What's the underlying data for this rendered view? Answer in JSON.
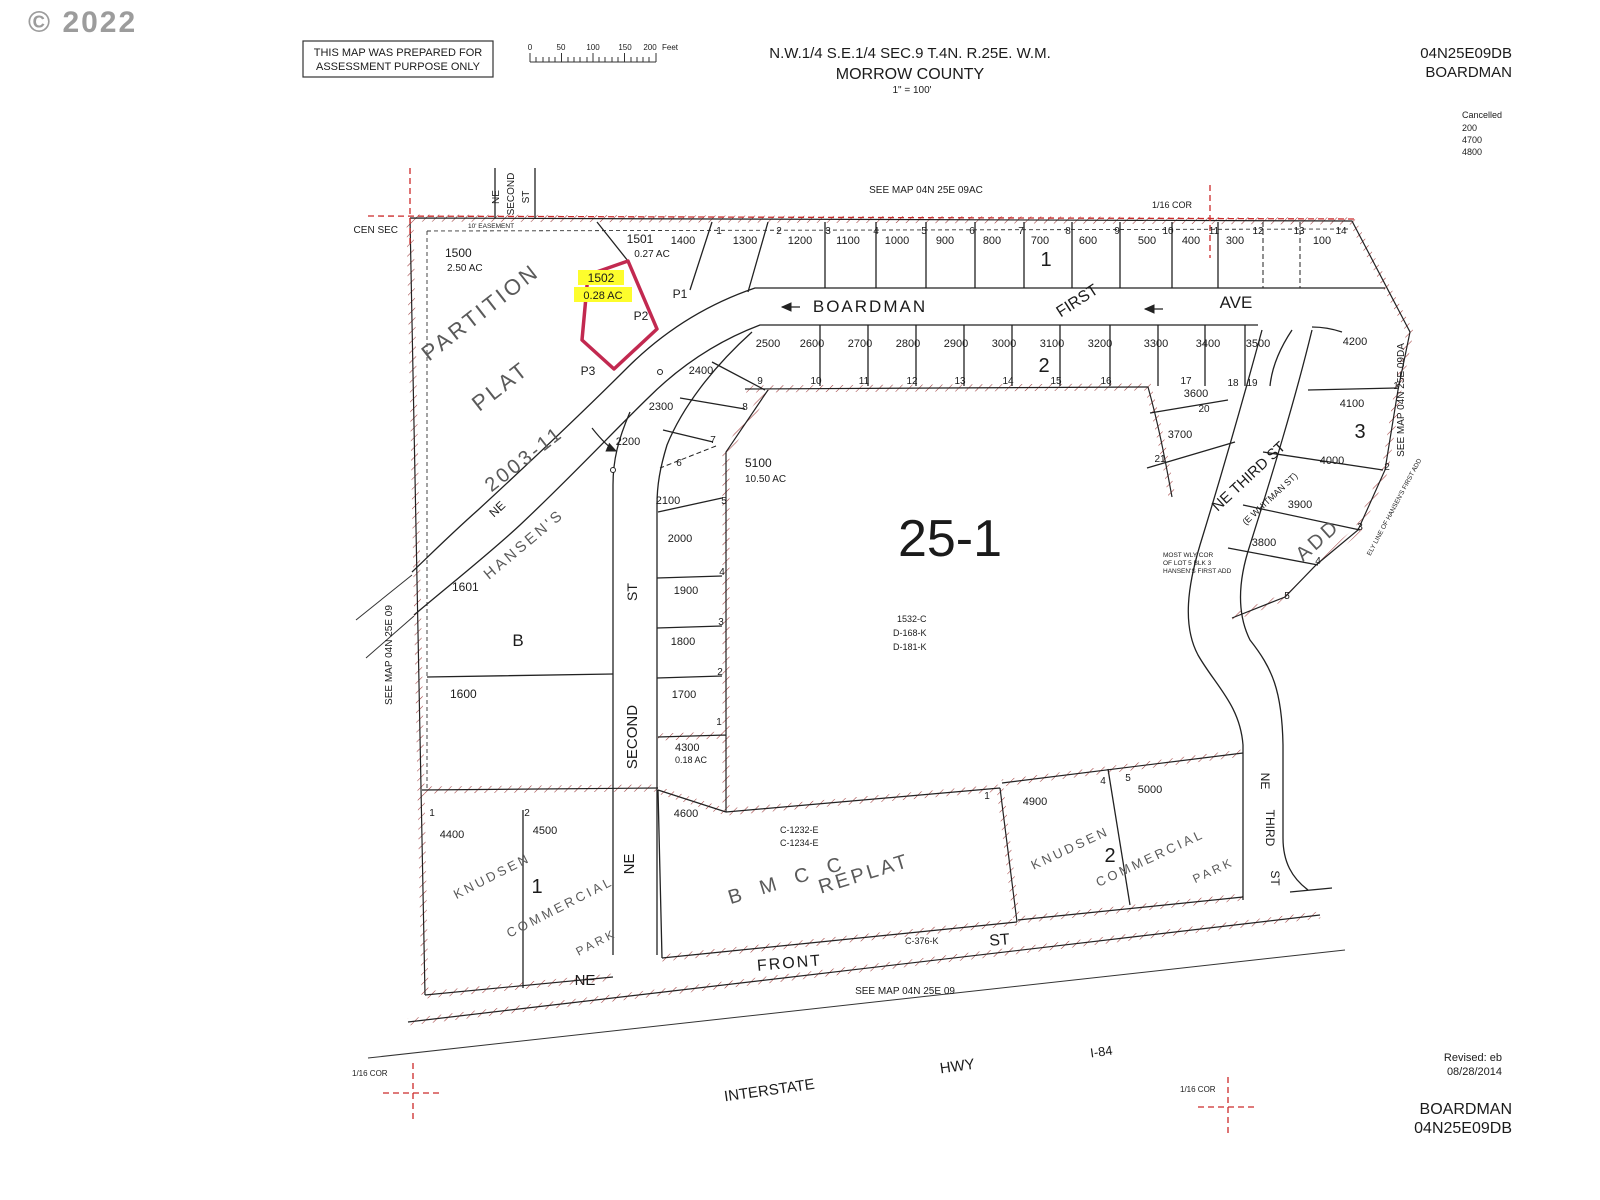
{
  "header": {
    "copyright": "© 2022",
    "disclaimer_line1": "THIS MAP WAS PREPARED FOR",
    "disclaimer_line2": "ASSESSMENT PURPOSE ONLY",
    "scale": {
      "ticks": [
        "0",
        "50",
        "100",
        "150",
        "200"
      ],
      "unit": "Feet"
    },
    "title_line1": "N.W.1/4 S.E.1/4 SEC.9 T.4N. R.25E. W.M.",
    "title_line2": "MORROW COUNTY",
    "title_line3": "1\" = 100'",
    "sheet_id": "04N25E09DB",
    "sheet_name": "BOARDMAN",
    "cancelled_label": "Cancelled",
    "cancelled_lots": [
      "200",
      "4700",
      "4800"
    ]
  },
  "footer": {
    "revised_label": "Revised: eb",
    "revised_date": "08/28/2014",
    "sheet_name": "BOARDMAN",
    "sheet_id": "04N25E09DB"
  },
  "map": {
    "refs": {
      "see_map_top": "SEE MAP 04N 25E 09AC",
      "see_map_left": "SEE MAP 04N 25E 09",
      "see_map_right": "SEE MAP 04N 25E 09DA",
      "see_map_bottom": "SEE MAP 04N 25E 09",
      "cor16": "1/16 COR",
      "cen_sec": "CEN SEC",
      "easement": "10' EASEMENT"
    },
    "streets": {
      "ne": "NE",
      "second": "SECOND",
      "st": "ST",
      "boardman": "BOARDMAN",
      "first": "FIRST",
      "ave": "AVE",
      "hansens": "HANSEN'S",
      "third_st": "NE THIRD ST",
      "whitman": "(E WHITMAN ST)",
      "third": "THIRD",
      "front": "FRONT",
      "interstate": "INTERSTATE",
      "hwy": "HWY",
      "i84": "I-84"
    },
    "subs": {
      "partition": "PARTITION",
      "plat": "PLAT",
      "plat_no": "2003-11",
      "add": "ADD",
      "bmcc": "B M C C",
      "replat": "REPLAT",
      "knudsen": "KNUDSEN",
      "commercial": "COMMERCIAL",
      "park": "PARK"
    },
    "blocks": {
      "b1": "1",
      "b2": "2",
      "b3": "3",
      "bB": "B",
      "k1": "1",
      "k2": "2",
      "area": "25-1"
    },
    "deeds": [
      "1532-C",
      "D-168-K",
      "D-181-K"
    ],
    "bmcc_refs": [
      "C-1232-E",
      "C-1234-E",
      "C-376-K"
    ],
    "notes": {
      "wly1": "MOST WLY COR",
      "wly2": "OF LOT 5 BLK 3",
      "wly3": "HANSEN'S FIRST ADD",
      "ely": "ELY LINE OF HANSEN'S FIRST ADD"
    },
    "highlight": {
      "lot": "1502",
      "ac": "0.28 AC"
    },
    "named_lots": {
      "l1500": "1500",
      "l1500ac": "2.50 AC",
      "l1501": "1501",
      "l1501ac": "0.27 AC",
      "l5100": "5100",
      "l5100ac": "10.50 AC",
      "l4300": "4300",
      "l4300ac": "0.18 AC",
      "l1601": "1601",
      "l1600": "1600",
      "p1": "P1",
      "p2": "P2",
      "p3": "P3",
      "l4400": "4400",
      "l4500": "4500",
      "l4600": "4600",
      "l4900": "4900",
      "l5000": "5000"
    },
    "top_row": [
      "1400",
      "1300",
      "1200",
      "1100",
      "1000",
      "900",
      "800",
      "700",
      "600",
      "500",
      "400",
      "300",
      "100"
    ],
    "top_corners": [
      "1",
      "2",
      "3",
      "4",
      "5",
      "6",
      "7",
      "8",
      "9",
      "10",
      "11",
      "12",
      "13",
      "14"
    ],
    "row2": [
      "2500",
      "2600",
      "2700",
      "2800",
      "2900",
      "3000",
      "3100",
      "3200",
      "3300",
      "3400",
      "3500"
    ],
    "row2_corners": [
      "9",
      "10",
      "11",
      "12",
      "13",
      "14",
      "15",
      "16",
      "17",
      "18",
      "19"
    ],
    "west": [
      "2400",
      "2300",
      "2200",
      "2100",
      "2000",
      "1900",
      "1800",
      "1700"
    ],
    "west_corners": [
      "8",
      "7",
      "6",
      "5",
      "4",
      "3",
      "2",
      "1"
    ],
    "east": [
      "4200",
      "4100",
      "4000",
      "3900",
      "3800",
      "3600",
      "3700"
    ],
    "east_corners": [
      "1",
      "2",
      "3",
      "4",
      "5",
      "20",
      "21"
    ],
    "south_corners": [
      "1",
      "2",
      "1",
      "4",
      "5"
    ]
  },
  "colors": {
    "hatch": "#a03b3b",
    "section_red": "#cc2a2a",
    "parcel_red": "#c22950",
    "highlight": "#fdfd2c",
    "ink": "#1b1b1b",
    "stencil": "#5a5a5a",
    "watermark": "#9c9c9c"
  }
}
